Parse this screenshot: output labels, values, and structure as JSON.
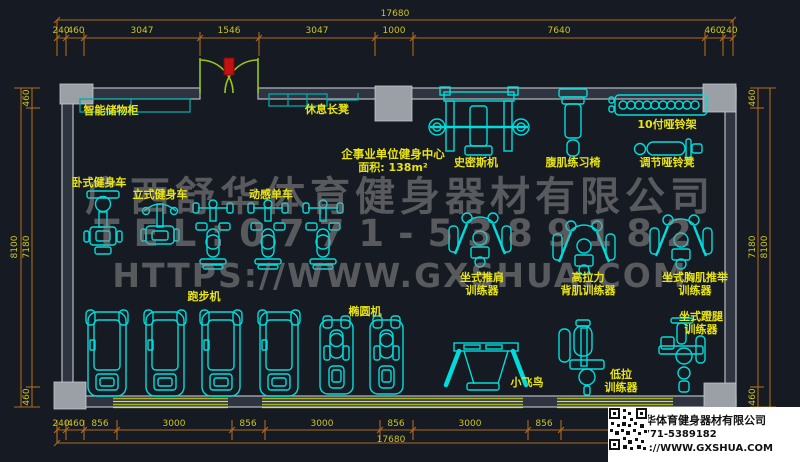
{
  "colors": {
    "bg": "#161b23",
    "cyan": "#00dcdc",
    "teal": "#00a9a9",
    "wall": "#9aa0a6",
    "wallfill": "#2e3540",
    "dim": "#b06a1e",
    "dimtext": "#cdc41e",
    "label": "#e8e415",
    "door": "#9ec41a",
    "win": "#a8b41c",
    "winlight": "#d6e23c",
    "watermark": "#8f8f8f",
    "red": "#c41111"
  },
  "dimensions": {
    "top": {
      "total": "17680",
      "segments": [
        "240",
        "460",
        "3047",
        "1546",
        "3047",
        "1000",
        "7640",
        "460",
        "240"
      ]
    },
    "bottom": {
      "total": "17680",
      "segments": [
        "240",
        "460",
        "856",
        "3000",
        "856",
        "3000",
        "856",
        "3000",
        "856"
      ]
    },
    "left": {
      "total": "8100",
      "segments": [
        "460",
        "7180",
        "460"
      ]
    },
    "right": {
      "total": "8100",
      "segments": [
        "460",
        "7180",
        "460"
      ]
    }
  },
  "room": {
    "name": "企事业单位健身中心",
    "area": "面积: 138m²"
  },
  "labels": {
    "locker": "智能储物柜",
    "rest_bench": "休息长凳",
    "smith_machine": "史密斯机",
    "ab_chair": "腹肌练习椅",
    "dumbbell_rack": "10付哑铃架",
    "dumbbell_bench": "调节哑铃凳",
    "recumbent_bike": "卧式健身车",
    "upright_bike": "立式健身车",
    "spin_bike": "动感单车",
    "shoulder_press": "坐式推肩\n训练器",
    "lat_pull": "高拉力\n背肌训练器",
    "chest_press": "坐式胸肌推举\n训练器",
    "treadmill": "跑步机",
    "elliptical": "椭圆机",
    "cable_cross": "小飞鸟",
    "low_pull": "低拉\n训练器",
    "leg_press": "坐式蹬腿\n训练器"
  },
  "watermark": {
    "line1": "广西舒华体育健身器材有限公司",
    "line2": "TEL:0771-5389182",
    "line3": "HTTPS://WWW.GXSHUA.COM"
  },
  "title_block": {
    "company": "广西舒华体育健身器材有限公司",
    "tel": "TEL:0771-5389182",
    "url": "HTTPS://WWW.GXSHUA.COM"
  }
}
